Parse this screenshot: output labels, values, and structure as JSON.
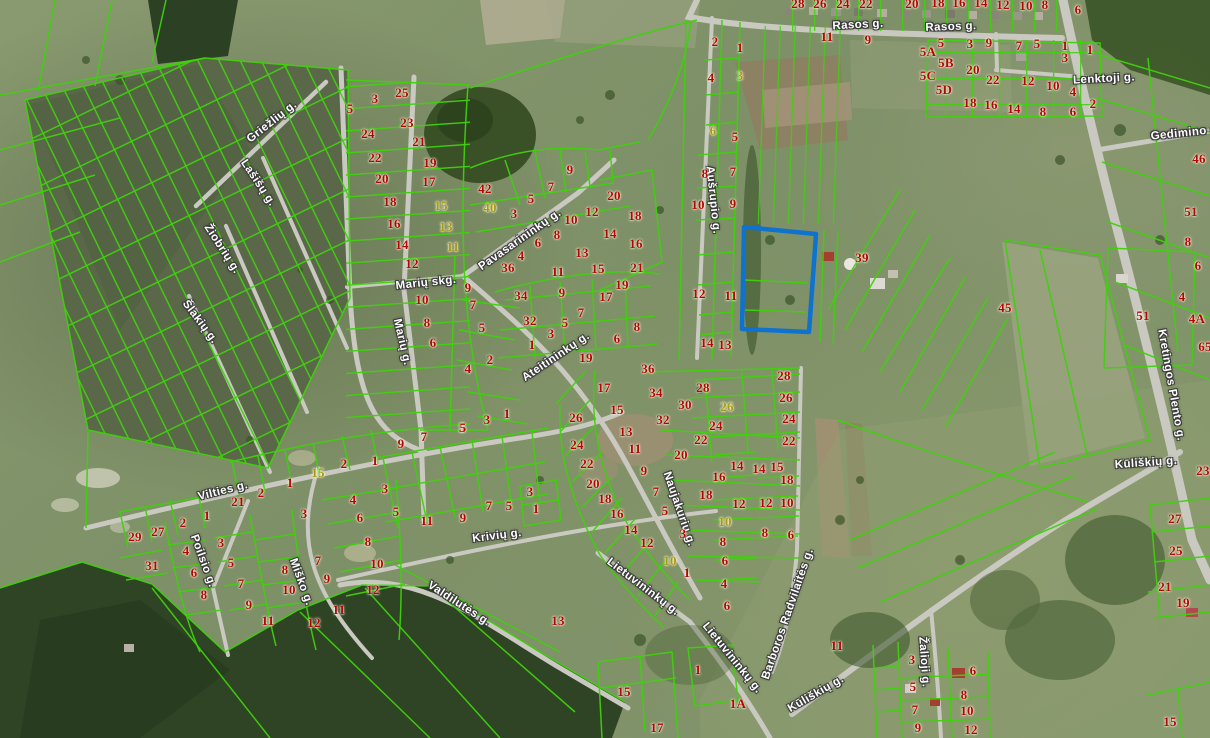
{
  "map": {
    "type": "aerial-cadastral-map",
    "colors": {
      "parcel_line": "#3fd10d",
      "highlight_outline": "#0e72cf",
      "parcel_number": "#b00606",
      "parcel_number_alt": "#a89a10",
      "street_text": "#ffffff",
      "road": "#c9c9c1"
    },
    "street_label_format": [
      "text",
      "x",
      "y",
      "rotation_deg"
    ],
    "street_labels": [
      [
        "Rasos g.",
        858,
        25,
        -3
      ],
      [
        "Rasos g.",
        951,
        27,
        -2
      ],
      [
        "Lenktoji g.",
        1104,
        79,
        -3
      ],
      [
        "Gedimino g.",
        1186,
        133,
        -6
      ],
      [
        "Griežlių g.",
        272,
        122,
        -38
      ],
      [
        "Lašišų g.",
        258,
        183,
        56
      ],
      [
        "Žiobrių g.",
        222,
        249,
        57
      ],
      [
        "Šlakių g.",
        200,
        322,
        53
      ],
      [
        "Marių skg.",
        426,
        283,
        -6
      ],
      [
        "Marių g.",
        402,
        342,
        77
      ],
      [
        "Pavasarininkų g.",
        520,
        240,
        -35
      ],
      [
        "Ateitininkų g.",
        556,
        357,
        -34
      ],
      [
        "Aušrupio g.",
        713,
        200,
        84
      ],
      [
        "Naujakurių g.",
        679,
        509,
        71
      ],
      [
        "Lietuvininkų g.",
        643,
        587,
        37
      ],
      [
        "Lietuvininkų g.",
        732,
        658,
        51
      ],
      [
        "Barboros Radvilaitės g.",
        788,
        614,
        -71
      ],
      [
        "Kūliškių g.",
        816,
        694,
        -30
      ],
      [
        "Kūliškių g.",
        1146,
        463,
        -4
      ],
      [
        "Kretingos Plento g.",
        1171,
        385,
        80
      ],
      [
        "Vilties g.",
        223,
        491,
        -14
      ],
      [
        "Poilsio g.",
        203,
        561,
        70
      ],
      [
        "Miško g.",
        301,
        582,
        70
      ],
      [
        "Krivių g.",
        497,
        536,
        -7
      ],
      [
        "Valdilutės g.",
        459,
        604,
        33
      ],
      [
        "Žalioji g.",
        924,
        662,
        86
      ]
    ],
    "parcel_number_format": [
      "text",
      "x",
      "y",
      "optional_color_variant"
    ],
    "parcel_numbers": [
      [
        "28",
        798,
        4
      ],
      [
        "26",
        820,
        4
      ],
      [
        "24",
        843,
        4
      ],
      [
        "22",
        866,
        4
      ],
      [
        "20",
        912,
        4
      ],
      [
        "18",
        938,
        3
      ],
      [
        "16",
        959,
        3
      ],
      [
        "14",
        981,
        3
      ],
      [
        "12",
        1003,
        5
      ],
      [
        "10",
        1026,
        6
      ],
      [
        "8",
        1045,
        5
      ],
      [
        "6",
        1078,
        10
      ],
      [
        "11",
        827,
        37
      ],
      [
        "9",
        868,
        40
      ],
      [
        "2",
        715,
        42
      ],
      [
        "1",
        740,
        48
      ],
      [
        "4",
        711,
        78
      ],
      [
        "3",
        740,
        76,
        "y"
      ],
      [
        "6",
        713,
        131,
        "y"
      ],
      [
        "5",
        735,
        137
      ],
      [
        "5A",
        928,
        52
      ],
      [
        "5",
        941,
        43
      ],
      [
        "3",
        970,
        44
      ],
      [
        "9",
        989,
        43
      ],
      [
        "7",
        1019,
        46
      ],
      [
        "5",
        1037,
        44
      ],
      [
        "1",
        1065,
        46
      ],
      [
        "3",
        1065,
        58
      ],
      [
        "1",
        1090,
        50
      ],
      [
        "5B",
        946,
        63
      ],
      [
        "5C",
        928,
        76
      ],
      [
        "20",
        973,
        70
      ],
      [
        "22",
        993,
        80
      ],
      [
        "12",
        1028,
        81
      ],
      [
        "10",
        1053,
        86
      ],
      [
        "4",
        1073,
        92
      ],
      [
        "2",
        1093,
        104
      ],
      [
        "5D",
        944,
        90
      ],
      [
        "18",
        970,
        103
      ],
      [
        "16",
        991,
        105
      ],
      [
        "14",
        1014,
        109
      ],
      [
        "8",
        1043,
        112
      ],
      [
        "6",
        1073,
        112
      ],
      [
        "46",
        1199,
        159
      ],
      [
        "51",
        1191,
        212
      ],
      [
        "8",
        1188,
        242
      ],
      [
        "6",
        1198,
        266
      ],
      [
        "4",
        1182,
        297
      ],
      [
        "4A",
        1197,
        319
      ],
      [
        "51",
        1143,
        316
      ],
      [
        "65",
        1205,
        347
      ],
      [
        "45",
        1005,
        308
      ],
      [
        "23",
        1203,
        471
      ],
      [
        "27",
        1175,
        519
      ],
      [
        "25",
        1176,
        551
      ],
      [
        "21",
        1165,
        587
      ],
      [
        "19",
        1183,
        603
      ],
      [
        "15",
        1170,
        722
      ],
      [
        "8",
        705,
        174
      ],
      [
        "7",
        733,
        172
      ],
      [
        "10",
        698,
        205
      ],
      [
        "9",
        733,
        204
      ],
      [
        "12",
        699,
        294
      ],
      [
        "11",
        731,
        296
      ],
      [
        "14",
        707,
        343
      ],
      [
        "13",
        725,
        345
      ],
      [
        "39",
        862,
        258
      ],
      [
        "5",
        350,
        109
      ],
      [
        "3",
        375,
        99
      ],
      [
        "25",
        402,
        93
      ],
      [
        "24",
        368,
        134
      ],
      [
        "23",
        407,
        123
      ],
      [
        "22",
        375,
        158
      ],
      [
        "21",
        419,
        142
      ],
      [
        "20",
        382,
        179
      ],
      [
        "19",
        430,
        163
      ],
      [
        "18",
        390,
        202
      ],
      [
        "17",
        429,
        182
      ],
      [
        "16",
        394,
        224
      ],
      [
        "15",
        441,
        206,
        "y"
      ],
      [
        "14",
        402,
        245
      ],
      [
        "13",
        446,
        227,
        "y"
      ],
      [
        "12",
        412,
        264
      ],
      [
        "11",
        453,
        247,
        "y"
      ],
      [
        "10",
        422,
        300
      ],
      [
        "9",
        468,
        288
      ],
      [
        "8",
        427,
        323
      ],
      [
        "7",
        473,
        305
      ],
      [
        "6",
        433,
        343
      ],
      [
        "5",
        482,
        328
      ],
      [
        "4",
        468,
        369
      ],
      [
        "2",
        490,
        360
      ],
      [
        "42",
        485,
        189
      ],
      [
        "40",
        490,
        208,
        "y"
      ],
      [
        "5",
        531,
        199
      ],
      [
        "7",
        551,
        187
      ],
      [
        "9",
        570,
        170
      ],
      [
        "3",
        514,
        214
      ],
      [
        "10",
        571,
        220
      ],
      [
        "12",
        592,
        212
      ],
      [
        "20",
        614,
        196
      ],
      [
        "18",
        635,
        216
      ],
      [
        "14",
        610,
        234
      ],
      [
        "16",
        636,
        244
      ],
      [
        "8",
        557,
        235
      ],
      [
        "6",
        538,
        243
      ],
      [
        "4",
        521,
        256
      ],
      [
        "36",
        508,
        268
      ],
      [
        "11",
        558,
        272
      ],
      [
        "13",
        582,
        253
      ],
      [
        "15",
        598,
        269
      ],
      [
        "21",
        637,
        268
      ],
      [
        "19",
        622,
        285
      ],
      [
        "34",
        521,
        296
      ],
      [
        "9",
        562,
        293
      ],
      [
        "17",
        606,
        297
      ],
      [
        "8",
        637,
        327
      ],
      [
        "6",
        617,
        339
      ],
      [
        "7",
        581,
        313
      ],
      [
        "32",
        530,
        321
      ],
      [
        "5",
        565,
        323
      ],
      [
        "3",
        551,
        334
      ],
      [
        "1",
        532,
        345
      ],
      [
        "19",
        586,
        358
      ],
      [
        "36",
        648,
        369
      ],
      [
        "1",
        507,
        414
      ],
      [
        "3",
        487,
        420
      ],
      [
        "5",
        462,
        428
      ],
      [
        "17",
        604,
        388
      ],
      [
        "34",
        656,
        393
      ],
      [
        "15",
        617,
        410
      ],
      [
        "13",
        626,
        432
      ],
      [
        "11",
        635,
        449
      ],
      [
        "9",
        644,
        471
      ],
      [
        "7",
        656,
        492
      ],
      [
        "5",
        665,
        511
      ],
      [
        "3",
        683,
        534
      ],
      [
        "1",
        687,
        573
      ],
      [
        "26",
        576,
        418
      ],
      [
        "24",
        577,
        445
      ],
      [
        "22",
        587,
        464
      ],
      [
        "20",
        593,
        484
      ],
      [
        "18",
        605,
        499
      ],
      [
        "16",
        617,
        514
      ],
      [
        "14",
        631,
        530
      ],
      [
        "12",
        647,
        543
      ],
      [
        "10",
        670,
        561,
        "y"
      ],
      [
        "28",
        703,
        388
      ],
      [
        "30",
        685,
        405
      ],
      [
        "32",
        663,
        420
      ],
      [
        "26",
        727,
        407,
        "y"
      ],
      [
        "24",
        716,
        426
      ],
      [
        "22",
        701,
        440
      ],
      [
        "20",
        681,
        455
      ],
      [
        "16",
        719,
        477
      ],
      [
        "18",
        706,
        495
      ],
      [
        "14",
        737,
        466
      ],
      [
        "12",
        739,
        504
      ],
      [
        "10",
        725,
        522,
        "y"
      ],
      [
        "8",
        723,
        542
      ],
      [
        "6",
        725,
        561
      ],
      [
        "4",
        724,
        584
      ],
      [
        "6",
        727,
        606
      ],
      [
        "14",
        759,
        469
      ],
      [
        "15",
        777,
        467
      ],
      [
        "18",
        787,
        480
      ],
      [
        "12",
        766,
        503
      ],
      [
        "10",
        787,
        503
      ],
      [
        "8",
        765,
        533
      ],
      [
        "6",
        791,
        535
      ],
      [
        "28",
        784,
        376
      ],
      [
        "26",
        786,
        398
      ],
      [
        "24",
        789,
        419
      ],
      [
        "22",
        789,
        441
      ],
      [
        "15",
        624,
        692
      ],
      [
        "17",
        657,
        728
      ],
      [
        "1",
        698,
        670
      ],
      [
        "1A",
        738,
        704
      ],
      [
        "11",
        837,
        646
      ],
      [
        "13",
        558,
        621
      ],
      [
        "3",
        912,
        660
      ],
      [
        "5",
        913,
        687
      ],
      [
        "7",
        915,
        710
      ],
      [
        "9",
        918,
        728
      ],
      [
        "6",
        973,
        671
      ],
      [
        "8",
        964,
        695
      ],
      [
        "10",
        967,
        711
      ],
      [
        "12",
        971,
        730
      ],
      [
        "29",
        135,
        537
      ],
      [
        "27",
        158,
        532
      ],
      [
        "2",
        183,
        523
      ],
      [
        "1",
        207,
        516
      ],
      [
        "31",
        152,
        566
      ],
      [
        "4",
        186,
        551
      ],
      [
        "6",
        194,
        573
      ],
      [
        "8",
        204,
        595
      ],
      [
        "3",
        221,
        543
      ],
      [
        "5",
        231,
        563
      ],
      [
        "7",
        241,
        584
      ],
      [
        "9",
        249,
        605
      ],
      [
        "11",
        268,
        621
      ],
      [
        "21",
        238,
        502
      ],
      [
        "2",
        261,
        493
      ],
      [
        "1",
        290,
        483
      ],
      [
        "15",
        318,
        473,
        "y"
      ],
      [
        "2",
        344,
        464
      ],
      [
        "1",
        375,
        461
      ],
      [
        "3",
        304,
        514
      ],
      [
        "8",
        285,
        570
      ],
      [
        "10",
        289,
        590
      ],
      [
        "7",
        318,
        561
      ],
      [
        "9",
        327,
        579
      ],
      [
        "11",
        339,
        610
      ],
      [
        "12",
        314,
        623
      ],
      [
        "4",
        353,
        500
      ],
      [
        "6",
        360,
        518
      ],
      [
        "8",
        368,
        542
      ],
      [
        "10",
        377,
        564
      ],
      [
        "12",
        373,
        590
      ],
      [
        "3",
        385,
        489
      ],
      [
        "5",
        396,
        512
      ],
      [
        "9",
        401,
        444
      ],
      [
        "7",
        424,
        437
      ],
      [
        "5",
        463,
        428
      ],
      [
        "11",
        427,
        521
      ],
      [
        "9",
        463,
        518
      ],
      [
        "7",
        489,
        506
      ],
      [
        "5",
        509,
        506
      ],
      [
        "3",
        530,
        492
      ],
      [
        "1",
        536,
        509
      ]
    ],
    "highlighted_parcel": {
      "points": "744,227 816,234 809,332 742,329"
    }
  }
}
